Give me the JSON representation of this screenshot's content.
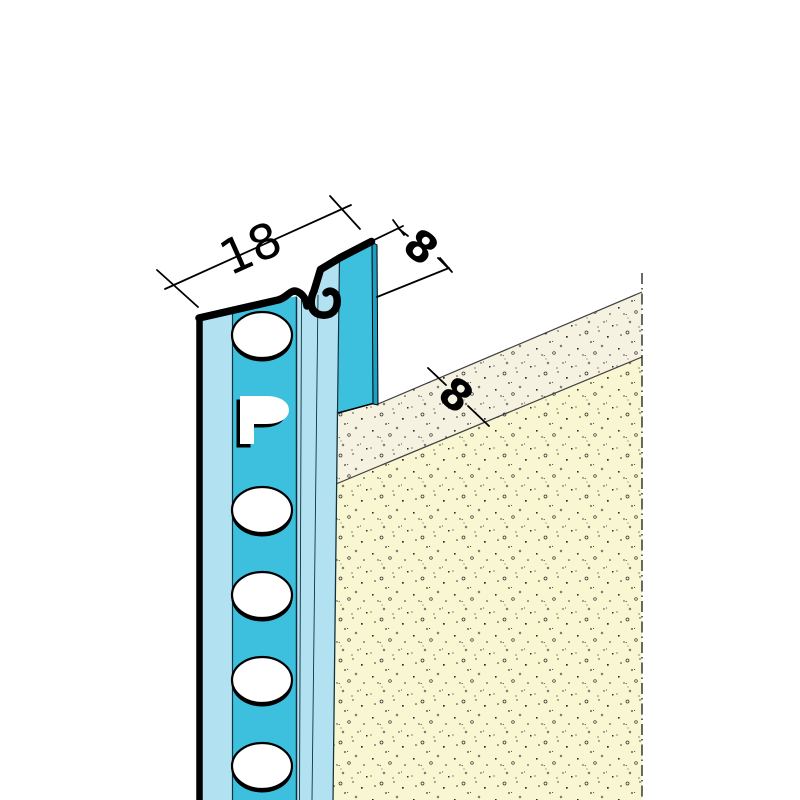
{
  "diagram": {
    "type": "technical-illustration",
    "subject": "plaster stop profile — isometric detail with plaster layer",
    "labels": {
      "dim_width": "18",
      "dim_flange": "8",
      "dim_thickness": "8",
      "logo_letter": "P"
    },
    "colors": {
      "profile_face": "#3cc0dd",
      "profile_side": "#b2e2f1",
      "flange_edge": "#1ba0c4",
      "plaster_surface": "#f5f2e2",
      "plaster_face": "#f9f7d2",
      "outline": "#000000",
      "construction_line": "#3f3f3f",
      "background": "#ffffff"
    }
  }
}
